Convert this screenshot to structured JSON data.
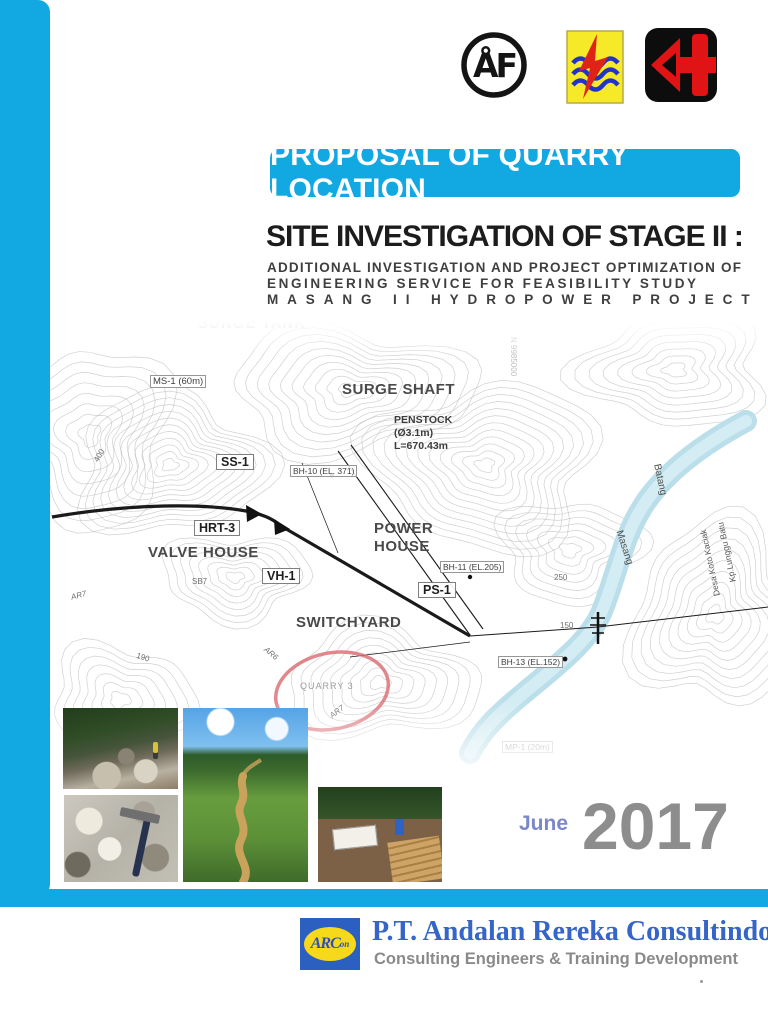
{
  "colors": {
    "accent_cyan": "#12a9e3",
    "title_black": "#1c1c1c",
    "month_blue": "#7c87c9",
    "year_gray": "#8d8d8d",
    "company_blue": "#3565c9",
    "tagline_gray": "#8a8a8a",
    "quarry_circle_red": "#d96a70",
    "river_blue": "#b7dde9"
  },
  "logos": {
    "af_monogram": "ÅF",
    "pln_icon": "lightning-over-waves",
    "partner_icon": "red-arrow-cross"
  },
  "banner": {
    "label": "PROPOSAL OF QUARRY LOCATION"
  },
  "title": {
    "main": "SITE INVESTIGATION OF STAGE II :",
    "sub1": "ADDITIONAL INVESTIGATION AND PROJECT OPTIMIZATION OF",
    "sub2": "ENGINEERING SERVICE FOR FEASIBILITY STUDY",
    "sub3": "MASANG II HYDROPOWER PROJECT"
  },
  "map": {
    "labels": {
      "surge_tank": "SURGE TANK",
      "ms1": "MS-1 (60m)",
      "surge_shaft": "SURGE SHAFT",
      "penstock_1": "PENSTOCK",
      "penstock_2": "(Ø3.1m)",
      "penstock_3": "L=670.43m",
      "ss1": "SS-1",
      "bh10": "BH-10 (EL. 371)",
      "hrt3": "HRT-3",
      "valve_house": "VALVE HOUSE",
      "sb7": "SB7",
      "vh1": "VH-1",
      "power": "POWER",
      "house": "HOUSE",
      "bh11": "BH-11 (EL.205)",
      "ps1": "PS-1",
      "switchyard": "SWITCHYARD",
      "ar6": "AR6",
      "quarry3": "QUARRY 3",
      "ar7_a": "AR7",
      "ar7_b": "AR7",
      "bh13": "BH-13 (EL.152)",
      "mp1": "MP-1 (20m)",
      "river_1": "Batang",
      "river_2": "Masang",
      "place_1": "Kp.Lunggu Batu",
      "place_2": "Desa Koto Kaciak",
      "northing": "N 9985000",
      "contour_400": "400",
      "contour_250": "250",
      "contour_150": "150",
      "contour_190": "190"
    }
  },
  "date": {
    "month": "June",
    "year": "2017"
  },
  "footer": {
    "logo_acronym": "ARC",
    "logo_suffix": "on",
    "company": "P.T. Andalan Rereka Consultindo",
    "tagline": "Consulting Engineers & Training Development"
  }
}
